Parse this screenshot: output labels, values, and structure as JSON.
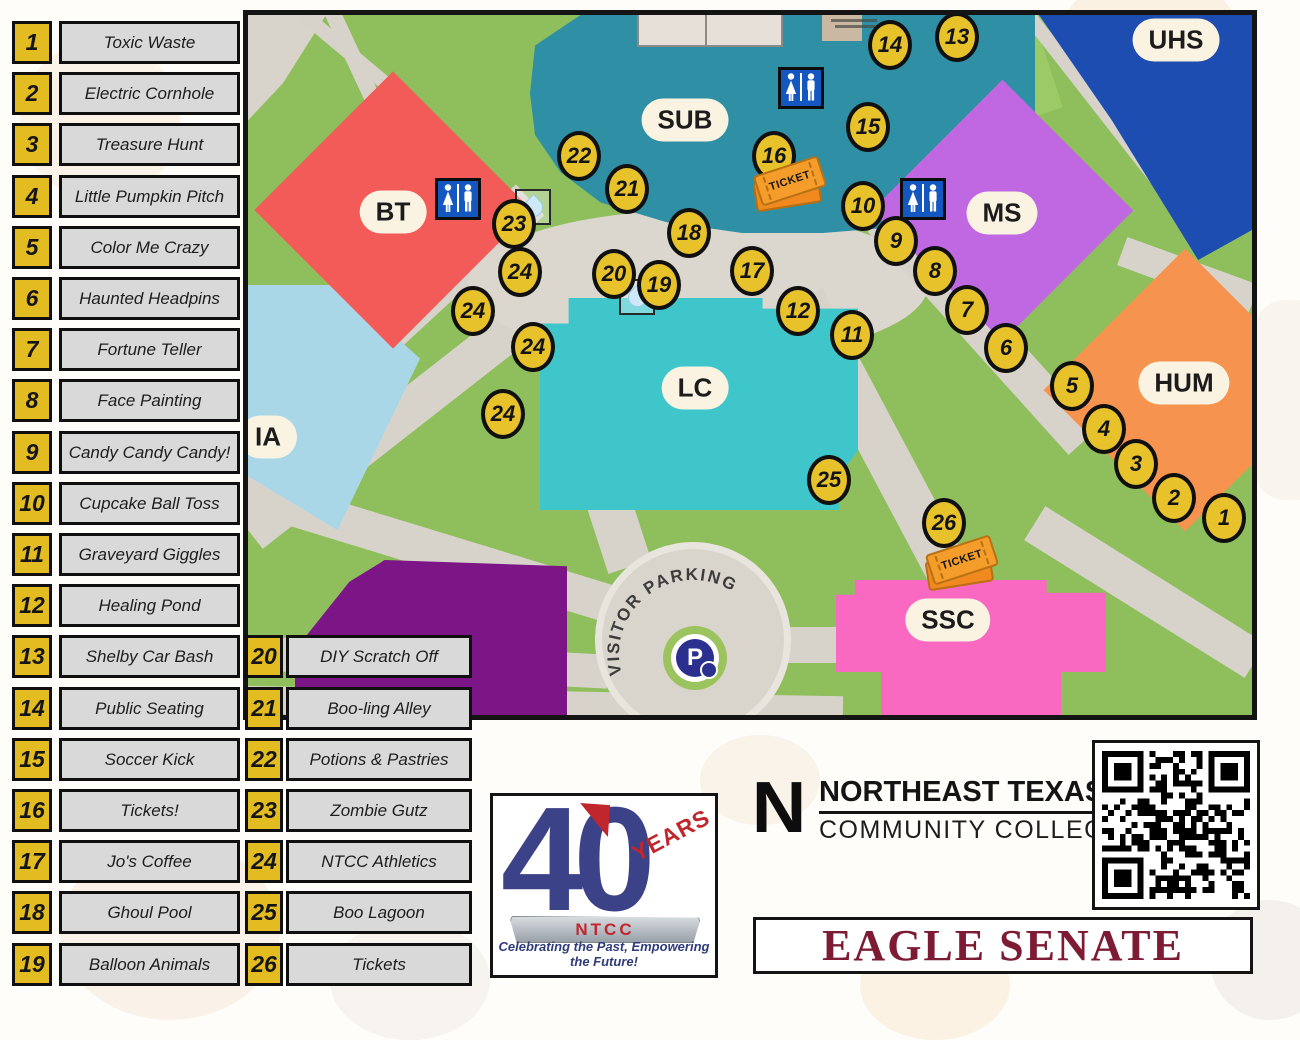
{
  "legend": {
    "column1": [
      {
        "num": "1",
        "label": "Toxic Waste"
      },
      {
        "num": "2",
        "label": "Electric Cornhole"
      },
      {
        "num": "3",
        "label": "Treasure Hunt"
      },
      {
        "num": "4",
        "label": "Little Pumpkin Pitch"
      },
      {
        "num": "5",
        "label": "Color Me Crazy"
      },
      {
        "num": "6",
        "label": "Haunted Headpins"
      },
      {
        "num": "7",
        "label": "Fortune Teller"
      },
      {
        "num": "8",
        "label": "Face Painting"
      },
      {
        "num": "9",
        "label": "Candy Candy Candy!"
      },
      {
        "num": "10",
        "label": "Cupcake Ball Toss"
      },
      {
        "num": "11",
        "label": "Graveyard Giggles"
      },
      {
        "num": "12",
        "label": "Healing Pond"
      },
      {
        "num": "13",
        "label": "Shelby Car Bash"
      },
      {
        "num": "14",
        "label": "Public Seating"
      },
      {
        "num": "15",
        "label": "Soccer Kick"
      },
      {
        "num": "16",
        "label": "Tickets!"
      },
      {
        "num": "17",
        "label": "Jo's Coffee"
      },
      {
        "num": "18",
        "label": "Ghoul Pool"
      },
      {
        "num": "19",
        "label": "Balloon Animals"
      }
    ],
    "column2": [
      {
        "num": "20",
        "label": "DIY Scratch Off"
      },
      {
        "num": "21",
        "label": "Boo-ling Alley"
      },
      {
        "num": "22",
        "label": "Potions & Pastries"
      },
      {
        "num": "23",
        "label": "Zombie Gutz"
      },
      {
        "num": "24",
        "label": "NTCC Athletics"
      },
      {
        "num": "25",
        "label": "Boo Lagoon"
      },
      {
        "num": "26",
        "label": "Tickets"
      }
    ]
  },
  "map": {
    "buildings": [
      {
        "id": "bt",
        "label": "BT",
        "x": 145,
        "y": 197,
        "color": "#F25B57"
      },
      {
        "id": "sub",
        "label": "SUB",
        "x": 437,
        "y": 105,
        "color": "#2F8FA5"
      },
      {
        "id": "uhs",
        "label": "UHS",
        "x": 928,
        "y": 25,
        "color": "#1D4DB0"
      },
      {
        "id": "ms",
        "label": "MS",
        "x": 754,
        "y": 198,
        "color": "#C068E2"
      },
      {
        "id": "hum",
        "label": "HUM",
        "x": 936,
        "y": 368,
        "color": "#F6944F"
      },
      {
        "id": "lc",
        "label": "LC",
        "x": 447,
        "y": 373,
        "color": "#3EC6CB"
      },
      {
        "id": "ssc",
        "label": "SSC",
        "x": 700,
        "y": 605,
        "color": "#F968C1"
      },
      {
        "id": "ia",
        "label": "IA",
        "x": 20,
        "y": 422,
        "color": "#A9D7E8"
      }
    ],
    "markers": [
      {
        "n": "1",
        "x": 976,
        "y": 503
      },
      {
        "n": "2",
        "x": 926,
        "y": 483
      },
      {
        "n": "3",
        "x": 888,
        "y": 449
      },
      {
        "n": "4",
        "x": 856,
        "y": 414
      },
      {
        "n": "5",
        "x": 824,
        "y": 371
      },
      {
        "n": "6",
        "x": 758,
        "y": 333
      },
      {
        "n": "7",
        "x": 719,
        "y": 295
      },
      {
        "n": "8",
        "x": 687,
        "y": 256
      },
      {
        "n": "9",
        "x": 648,
        "y": 226
      },
      {
        "n": "10",
        "x": 615,
        "y": 191
      },
      {
        "n": "11",
        "x": 604,
        "y": 320
      },
      {
        "n": "12",
        "x": 550,
        "y": 296
      },
      {
        "n": "13",
        "x": 709,
        "y": 22
      },
      {
        "n": "14",
        "x": 642,
        "y": 30
      },
      {
        "n": "15",
        "x": 620,
        "y": 112
      },
      {
        "n": "16",
        "x": 526,
        "y": 141
      },
      {
        "n": "17",
        "x": 504,
        "y": 256
      },
      {
        "n": "18",
        "x": 441,
        "y": 218
      },
      {
        "n": "19",
        "x": 411,
        "y": 270
      },
      {
        "n": "20",
        "x": 366,
        "y": 259
      },
      {
        "n": "21",
        "x": 379,
        "y": 174
      },
      {
        "n": "22",
        "x": 331,
        "y": 141
      },
      {
        "n": "23",
        "x": 266,
        "y": 209
      },
      {
        "n": "24",
        "x": 272,
        "y": 257
      },
      {
        "n": "24",
        "x": 225,
        "y": 296
      },
      {
        "n": "24",
        "x": 285,
        "y": 332
      },
      {
        "n": "24",
        "x": 255,
        "y": 399
      },
      {
        "n": "25",
        "x": 581,
        "y": 465
      },
      {
        "n": "26",
        "x": 696,
        "y": 508
      }
    ],
    "restrooms": [
      {
        "x": 553,
        "y": 73
      },
      {
        "x": 210,
        "y": 184
      },
      {
        "x": 675,
        "y": 184
      }
    ],
    "waterdrops": [
      {
        "x": 285,
        "y": 192
      },
      {
        "x": 389,
        "y": 282
      }
    ],
    "tickets": [
      {
        "x": 542,
        "y": 166,
        "label": "TICKET"
      },
      {
        "x": 714,
        "y": 545,
        "label": "TICKET"
      }
    ],
    "parking": {
      "text": "VISITOR PARKING",
      "letter": "P"
    }
  },
  "footer": {
    "logo40": {
      "big": "40",
      "years": "YEARS",
      "ribbon": "NTCC",
      "tagline": "Celebrating the Past, Empowering the Future!"
    },
    "college": {
      "initial": "N",
      "line1": "NORTHEAST TEXAS",
      "line2": "COMMUNITY COLLEGE"
    },
    "banner": "EAGLE SENATE"
  },
  "colors": {
    "legend_yellow": "#E3BC22",
    "legend_gray": "#D9D9D9",
    "marker_yellow": "#E7C22B",
    "map_green": "#8FBE5C",
    "path_gray": "#D7D3CB",
    "banner_maroon": "#7D1B35",
    "logo_navy": "#3C4287",
    "logo_red": "#C0272D",
    "restroom_blue": "#1557C0",
    "ticket_orange": "#F49D2A"
  }
}
